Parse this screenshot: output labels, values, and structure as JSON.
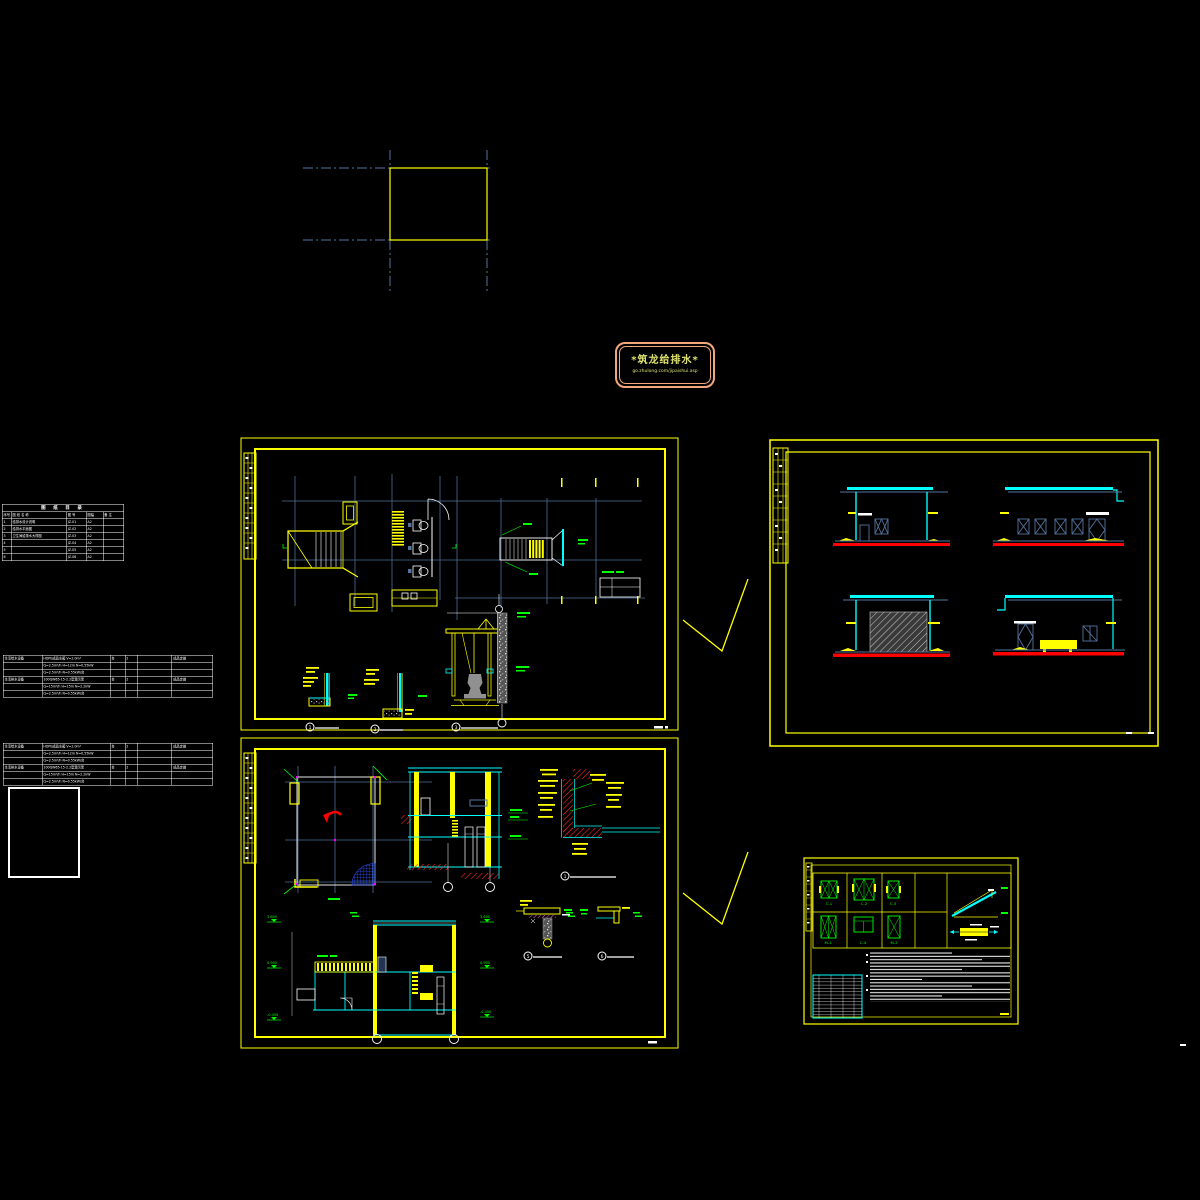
{
  "colors": {
    "background": "#000000",
    "sheet_border_yellow": "#ffff00",
    "cad_cyan": "#00ffff",
    "cad_red": "#ff0000",
    "cad_green": "#00ff00",
    "grid_blue": "#4e6f9c",
    "axis_line_blue": "#54749e",
    "hatch_blue": "#2b50ff",
    "magenta_marker": "#ff00ff",
    "logo_border_orange": "#f0a87a",
    "logo_text_olive": "#dde26e",
    "white": "#ffffff"
  },
  "logo": {
    "title": "*筑龙给排水*",
    "subtitle": "go.zhulong.com/jipaishui.asp"
  },
  "drawing_list": {
    "title": "图 纸 目 录",
    "rows": [
      [
        "序号",
        "图 纸 名 称",
        "图 号",
        "图幅",
        "备 注"
      ],
      [
        "1",
        "给排水设计说明",
        "JZ-01",
        "A2",
        ""
      ],
      [
        "2",
        "给排水平面图",
        "JZ-02",
        "A2",
        ""
      ],
      [
        "3",
        "卫生间给排水大样图",
        "JZ-03",
        "A2",
        ""
      ],
      [
        "4",
        "",
        "JZ-04",
        "A2",
        ""
      ],
      [
        "5",
        "",
        "JZ-05",
        "A2",
        ""
      ],
      [
        "6",
        "",
        "JZ-06",
        "A2",
        ""
      ]
    ]
  },
  "equipment_schedule": {
    "rows": [
      [
        "生活给水设备",
        "HDPE成品水箱 V=2.0m³",
        "台",
        "2",
        "",
        "成品定做"
      ],
      [
        "",
        "Q=2.5m³/h H=12m N=0.55kW",
        "",
        "",
        "",
        ""
      ],
      [
        "",
        "Q=2.5m³/h N=0.55kW/台",
        "",
        "",
        "",
        ""
      ],
      [
        "生活排水设备",
        "100QW65-15-2.2型潜污泵",
        "台",
        "2",
        "",
        "成品定做"
      ],
      [
        "",
        "Q=15m³/h H=15m N=2.2kW",
        "",
        "",
        "",
        ""
      ],
      [
        "",
        "Q=2.5m³/h N=0.55kW/台",
        "",
        "",
        "",
        ""
      ]
    ]
  },
  "sheet1": {
    "details": [
      "1",
      "2",
      "3"
    ]
  },
  "sheet2": {
    "details": [
      "1",
      "5",
      "6"
    ],
    "elevations": [
      "3.600",
      "0.900",
      "-0.450"
    ]
  },
  "schedule_sheet": {
    "labels": [
      "C-1",
      "C-2",
      "C-3",
      "M-1",
      "C-4",
      "M-2"
    ]
  }
}
